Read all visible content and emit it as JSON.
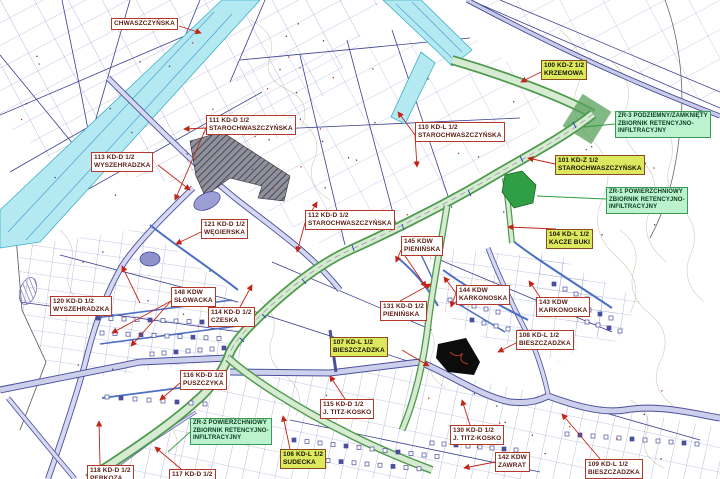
{
  "map": {
    "type": "zoning-plan-map",
    "language": "Polish",
    "accent_colors": {
      "label_border_red": "#b5372a",
      "label_yellow_bg": "#dce95e",
      "label_green_bg": "#bcf2cd",
      "road_green": "#4d9a4d",
      "road_cyan": "#b5e9f2",
      "road_violet": "#4a4f9e",
      "leader_red": "#c22418",
      "leader_green": "#2f9e44"
    }
  },
  "labels": [
    {
      "id": "chwaszczynska",
      "type": "white",
      "x": 111,
      "y": 18,
      "anchor": [
        179,
        26
      ],
      "leaders": [
        [
          201,
          33
        ]
      ],
      "lines": [
        "CHWASZCZYŃSKA"
      ]
    },
    {
      "id": "l100",
      "type": "yellow",
      "x": 541,
      "y": 60,
      "anchor": [
        541,
        72
      ],
      "leaders": [
        [
          521,
          82
        ]
      ],
      "lines": [
        "100 KD-Z 1/2",
        "KRZEMOWA"
      ]
    },
    {
      "id": "zr3",
      "type": "green",
      "x": 615,
      "y": 111,
      "anchor": [
        615,
        124
      ],
      "leaders": [
        [
          584,
          127
        ]
      ],
      "lines": [
        "ZR-3 PODZIEMNY/ZAMKNIĘTY",
        "ZBIORNIK RETENCYJNO-",
        "INFILTRACYJNY"
      ]
    },
    {
      "id": "l101",
      "type": "yellow",
      "x": 555,
      "y": 155,
      "anchor": [
        555,
        164
      ],
      "leaders": [
        [
          528,
          158
        ]
      ],
      "lines": [
        "101 KD-Z 1/2",
        "STAROCHWASZCZYŃSKA"
      ]
    },
    {
      "id": "zr1",
      "type": "green",
      "x": 606,
      "y": 187,
      "anchor": [
        606,
        199
      ],
      "leaders": [
        [
          537,
          196
        ]
      ],
      "lines": [
        "ZR-1 POWIERZCHNIOWY",
        "ZBIORNIK RETENCYJNO-",
        "INFILTRACYJNY"
      ]
    },
    {
      "id": "l104",
      "type": "yellow",
      "x": 546,
      "y": 229,
      "anchor": [
        556,
        229
      ],
      "leaders": [
        [
          508,
          227
        ]
      ],
      "lines": [
        "104 KD-L 1/2",
        "KACZE BUKI"
      ]
    },
    {
      "id": "l111",
      "type": "white",
      "x": 206,
      "y": 115,
      "anchor": [
        206,
        128
      ],
      "leaders": [
        [
          184,
          129
        ],
        [
          175,
          200
        ]
      ],
      "lines": [
        "111 KD-D 1/2",
        "STAROCHWASZCZYŃSKA"
      ]
    },
    {
      "id": "l110",
      "type": "white",
      "x": 415,
      "y": 122,
      "anchor": [
        415,
        135
      ],
      "leaders": [
        [
          398,
          112
        ],
        [
          417,
          167
        ]
      ],
      "lines": [
        "110 KD-L 1/2",
        "STAROCHWASZCZYŃSKA"
      ]
    },
    {
      "id": "l113",
      "type": "white",
      "x": 91,
      "y": 152,
      "anchor": [
        158,
        165
      ],
      "leaders": [
        [
          190,
          190
        ]
      ],
      "lines": [
        "113 KD-D 1/2",
        "WYSZEHRADZKA"
      ]
    },
    {
      "id": "l121",
      "type": "white",
      "x": 201,
      "y": 219,
      "anchor": [
        201,
        232
      ],
      "leaders": [
        [
          176,
          244
        ]
      ],
      "lines": [
        "121 KD-D 1/2",
        "WĘGIERSKA"
      ]
    },
    {
      "id": "l112",
      "type": "white",
      "x": 305,
      "y": 210,
      "anchor": [
        305,
        223
      ],
      "leaders": [
        [
          317,
          202
        ],
        [
          297,
          252
        ]
      ],
      "lines": [
        "112 KD-D 1/2",
        "STAROCHWASZCZYŃSKA"
      ]
    },
    {
      "id": "l145",
      "type": "white",
      "x": 401,
      "y": 236,
      "anchor": [
        401,
        250
      ],
      "leaders": [
        [
          396,
          262
        ],
        [
          426,
          287
        ]
      ],
      "lines": [
        "145 KDW",
        "PIENIŃSKA"
      ]
    },
    {
      "id": "l120",
      "type": "white",
      "x": 50,
      "y": 296,
      "anchor": [
        140,
        303
      ],
      "leaders": [
        [
          122,
          266
        ]
      ],
      "lines": [
        "120 KD-D 1/2",
        "WYSZEHRADZKA"
      ]
    },
    {
      "id": "l148",
      "type": "white",
      "x": 171,
      "y": 287,
      "anchor": [
        171,
        301
      ],
      "leaders": [
        [
          112,
          333
        ],
        [
          131,
          346
        ]
      ],
      "lines": [
        "148 KDW",
        "SŁOWACKA"
      ]
    },
    {
      "id": "l114",
      "type": "white",
      "x": 208,
      "y": 307,
      "anchor": [
        240,
        307
      ],
      "leaders": [
        [
          252,
          285
        ]
      ],
      "lines": [
        "114 KD-D 1/2",
        "CZESKA"
      ]
    },
    {
      "id": "l131",
      "type": "white",
      "x": 380,
      "y": 301,
      "anchor": [
        400,
        301
      ],
      "leaders": [
        [
          431,
          284
        ]
      ],
      "lines": [
        "131 KD-D 1/2",
        "PIENIŃSKA"
      ]
    },
    {
      "id": "l144",
      "type": "white",
      "x": 456,
      "y": 285,
      "anchor": [
        456,
        293
      ],
      "leaders": [
        [
          444,
          277
        ],
        [
          451,
          307
        ]
      ],
      "lines": [
        "144 KDW",
        "KARKONOSKA"
      ]
    },
    {
      "id": "l143",
      "type": "white",
      "x": 536,
      "y": 297,
      "anchor": [
        540,
        297
      ],
      "leaders": [
        [
          529,
          281
        ]
      ],
      "lines": [
        "143 KDW",
        "KARKONOSKA"
      ]
    },
    {
      "id": "l107",
      "type": "yellow",
      "x": 330,
      "y": 337,
      "anchor": [
        402,
        350
      ],
      "leaders": [
        [
          429,
          366
        ]
      ],
      "lines": [
        "107 KD-L 1/2",
        "BIESZCZADZKA"
      ]
    },
    {
      "id": "l108",
      "type": "white",
      "x": 516,
      "y": 330,
      "anchor": [
        516,
        343
      ],
      "leaders": [
        [
          498,
          352
        ]
      ],
      "lines": [
        "108 KD-L 1/2",
        "BIESZCZADZKA"
      ]
    },
    {
      "id": "l116",
      "type": "white",
      "x": 180,
      "y": 370,
      "anchor": [
        180,
        383
      ],
      "leaders": [
        [
          160,
          400
        ]
      ],
      "lines": [
        "116 KD-D 1/2",
        "PUSZCZYKA"
      ]
    },
    {
      "id": "l115",
      "type": "white",
      "x": 320,
      "y": 399,
      "anchor": [
        345,
        399
      ],
      "leaders": [
        [
          330,
          376
        ]
      ],
      "lines": [
        "115 KD-D 1/2",
        "J. TITZ-KOSKO"
      ]
    },
    {
      "id": "zr2",
      "type": "green",
      "x": 190,
      "y": 418,
      "anchor": [
        190,
        432
      ],
      "leaders": [
        [
          168,
          452
        ]
      ],
      "lines": [
        "ZR-2 POWIERZCHNIOWY",
        "ZBIORNIK RETENCYJNO-",
        "INFILTRACYJNY"
      ]
    },
    {
      "id": "l106",
      "type": "yellow",
      "x": 280,
      "y": 449,
      "anchor": [
        290,
        449
      ],
      "leaders": [
        [
          283,
          416
        ]
      ],
      "lines": [
        "106 KD-L 1/2",
        "SUDECKA"
      ]
    },
    {
      "id": "l130",
      "type": "white",
      "x": 450,
      "y": 425,
      "anchor": [
        470,
        425
      ],
      "leaders": [
        [
          462,
          400
        ]
      ],
      "lines": [
        "130 KD-D 1/2",
        "J. TITZ-KOSKO"
      ]
    },
    {
      "id": "l142",
      "type": "white",
      "x": 495,
      "y": 452,
      "anchor": [
        495,
        462
      ],
      "leaders": [
        [
          464,
          468
        ]
      ],
      "lines": [
        "142 KDW",
        "ZAWRAT"
      ]
    },
    {
      "id": "l109",
      "type": "white",
      "x": 585,
      "y": 459,
      "anchor": [
        600,
        459
      ],
      "leaders": [
        [
          562,
          414
        ]
      ],
      "lines": [
        "109 KD-L 1/2",
        "BIESZCZADZKA"
      ]
    },
    {
      "id": "l118",
      "type": "white",
      "x": 87,
      "y": 465,
      "anchor": [
        100,
        465
      ],
      "leaders": [
        [
          99,
          421
        ]
      ],
      "lines": [
        "118 KD-D 1/2",
        "PERKOZA"
      ]
    },
    {
      "id": "l117",
      "type": "white",
      "x": 169,
      "y": 469,
      "anchor": [
        181,
        469
      ],
      "leaders": [
        [
          155,
          447
        ]
      ],
      "lines": [
        "117 KD-D 1/2"
      ]
    }
  ]
}
